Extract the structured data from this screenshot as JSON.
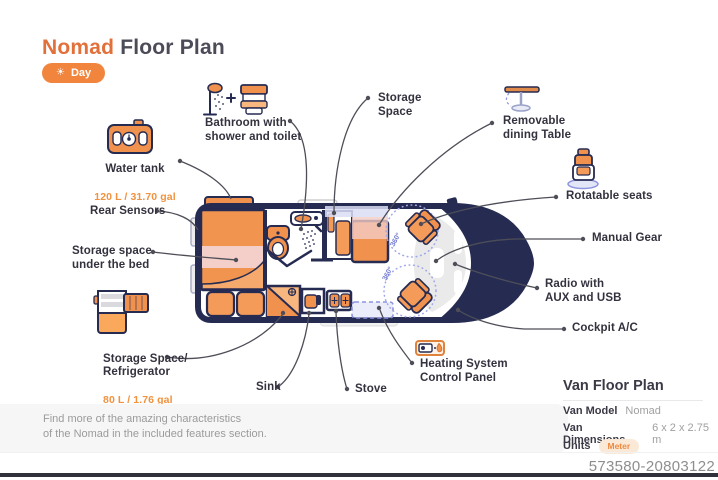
{
  "title": {
    "brand": "Nomad",
    "rest": "Floor Plan"
  },
  "mode_toggle": {
    "label": "Day",
    "icon": "sun-icon"
  },
  "callouts": {
    "water_tank": {
      "label": "Water tank",
      "sub": "120 L / 31.70 gal",
      "icon": "water-tank-icon"
    },
    "bathroom": {
      "label": "Bathroom with\nshower and toilet",
      "icon": "shower-toilet-icon"
    },
    "storage_space": {
      "label": "Storage\nSpace"
    },
    "dining_table": {
      "label": "Removable\ndining Table",
      "icon": "dining-table-icon"
    },
    "rotatable_seats": {
      "label": "Rotatable seats",
      "icon": "swivel-seat-icon"
    },
    "rear_sensors": {
      "label": "Rear Sensors"
    },
    "storage_under_bed": {
      "label": "Storage space\nunder the bed"
    },
    "manual_gear": {
      "label": "Manual Gear"
    },
    "radio": {
      "label": "Radio with\nAUX and USB"
    },
    "cockpit_ac": {
      "label": "Cockpit A/C"
    },
    "refrigerator": {
      "label": "Storage Space/\nRefrigerator",
      "sub": "80 L / 1.76 gal",
      "icon": "refrigerator-icon"
    },
    "sink": {
      "label": "Sink"
    },
    "stove": {
      "label": "Stove"
    },
    "heating": {
      "label": "Heating System\nControl Panel",
      "icon": "heating-panel-icon"
    }
  },
  "floorplan": {
    "rotation_front": "360°",
    "rotation_rear": "360°"
  },
  "note": {
    "text": "Find more of the amazing characteristics\nof the Nomad in the included features section."
  },
  "details": {
    "title": "Van Floor Plan",
    "model_label": "Van Model",
    "model_value": "Nomad",
    "dimensions_label": "Van Dimensions",
    "dimensions_value": "6 x 2 x 2.75 m",
    "units_label": "Units",
    "units_value": "Meter"
  },
  "serial": "573580-20803122",
  "colors": {
    "accent": "#ee8a3e",
    "navy": "#262b52",
    "purple": "#8c94e0",
    "pink": "#f2ccc6"
  }
}
